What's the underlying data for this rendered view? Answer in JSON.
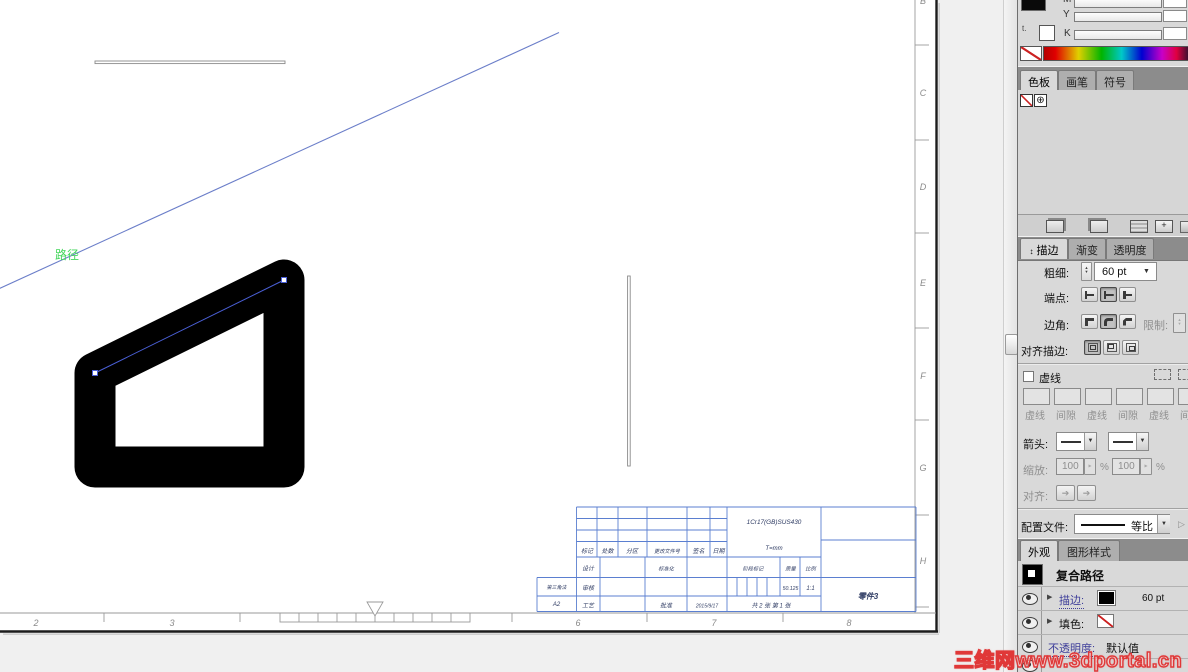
{
  "canvas": {
    "path_label": "路径",
    "zones_bottom": [
      "2",
      "3",
      "6",
      "7",
      "8"
    ],
    "zones_right": [
      "B",
      "C",
      "D",
      "E",
      "F",
      "G",
      "H"
    ]
  },
  "title_block": {
    "header_cols": [
      "标记",
      "处数",
      "分区",
      "更改文件号",
      "签名",
      "日期"
    ],
    "material": "1Cr17(GB)SUS430",
    "thickness": "T=mm",
    "design": "设计",
    "standardize": "标准化",
    "review": "审核",
    "process": "工艺",
    "approve": "批准",
    "date": "2015/9/17",
    "stage_mark": "阶段标记",
    "mass": "质量",
    "scale": "比例",
    "mass_value": "50.125",
    "scale_value": "1:1",
    "sheets": "共 2 张  第 1 张",
    "projection": "第三角法",
    "sheet_size": "A2",
    "part_name": "零件3"
  },
  "color_panel": {
    "m_label": "M",
    "y_label": "Y",
    "k_label": "K",
    "proxy_glyph": "t."
  },
  "swatches_panel": {
    "tabs": [
      "色板",
      "画笔",
      "符号"
    ]
  },
  "stroke_panel": {
    "tabs": [
      "描边",
      "渐变",
      "透明度"
    ],
    "weight_label": "粗细:",
    "weight_value": "60 pt",
    "cap_label": "端点:",
    "corner_label": "边角:",
    "limit_label": "限制:",
    "align_stroke_label": "对齐描边:",
    "dashed_label": "虚线",
    "dash_labels": [
      "虚线",
      "间隙",
      "虚线",
      "间隙",
      "虚线",
      "间隙"
    ],
    "arrow_label": "箭头:",
    "scale_label": "缩放:",
    "scale_value_1": "100",
    "scale_value_2": "100",
    "percent": "%",
    "align_label": "对齐:",
    "profile_label": "配置文件:",
    "profile_value": "等比"
  },
  "appearance_panel": {
    "tabs": [
      "外观",
      "图形样式"
    ],
    "item_title": "复合路径",
    "stroke_label": "描边:",
    "stroke_value": "60 pt",
    "fill_label": "填色:",
    "opacity_label": "不透明度:",
    "opacity_value": "默认值"
  },
  "icons": {
    "panel_toggle": "↕",
    "dropdown": "▼",
    "spin_up": "▲",
    "spin_down": "▼",
    "spin_right": "▶",
    "expand": "▶",
    "registration": "⊕",
    "advance": "▷",
    "new_plus": "+"
  },
  "watermark": "三维网www.3dportal.cn",
  "colors": {
    "table_line": "#5b7fd0",
    "selection_blue": "#4a5fd6",
    "guide_green": "#44d65c",
    "watermark_red": "#e03838"
  }
}
